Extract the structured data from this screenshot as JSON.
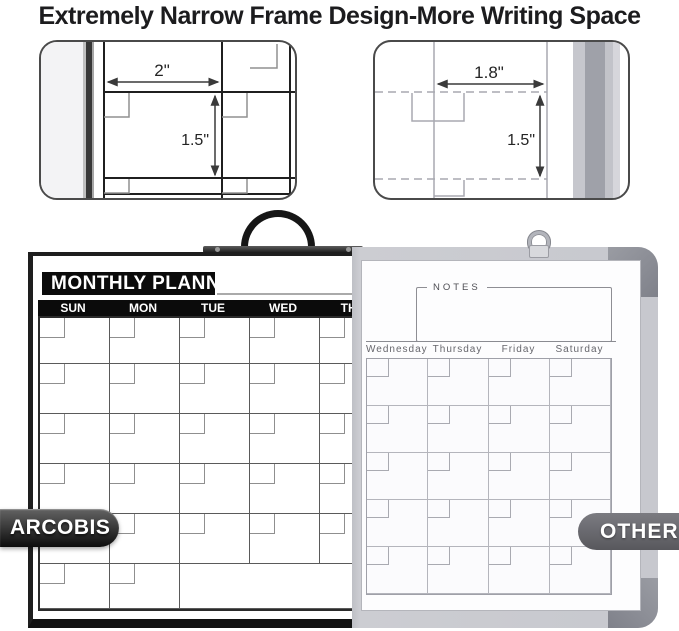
{
  "title": "Extremely Narrow Frame Design-More Writing Space",
  "closeups": {
    "arcobis": {
      "width_label": "2\"",
      "height_label": "1.5\""
    },
    "other": {
      "width_label": "1.8\"",
      "height_label": "1.5\""
    }
  },
  "arcobis_board": {
    "brand_badge": "ARCOBIS",
    "header": "MONTHLY PLANNER",
    "day_headers": [
      "SUN",
      "MON",
      "TUE",
      "WED",
      "THU"
    ]
  },
  "other_board": {
    "brand_badge": "OTHER",
    "notes_label": "NOTES",
    "day_headers": [
      "Wednesday",
      "Thursday",
      "Friday",
      "Saturday"
    ]
  },
  "colors": {
    "title_text": "#1c1c1e",
    "board_frame_black": "#1e1e1e",
    "banner_black": "#0b0b0b",
    "aluminum_frame_gray": "#c7c8ce",
    "corner_piece_gray": "#8e9097",
    "badge_other_gray": "#6b6b70",
    "grid_line_dark": "#5a5a5a",
    "grid_line_light": "#b4b5bc"
  }
}
